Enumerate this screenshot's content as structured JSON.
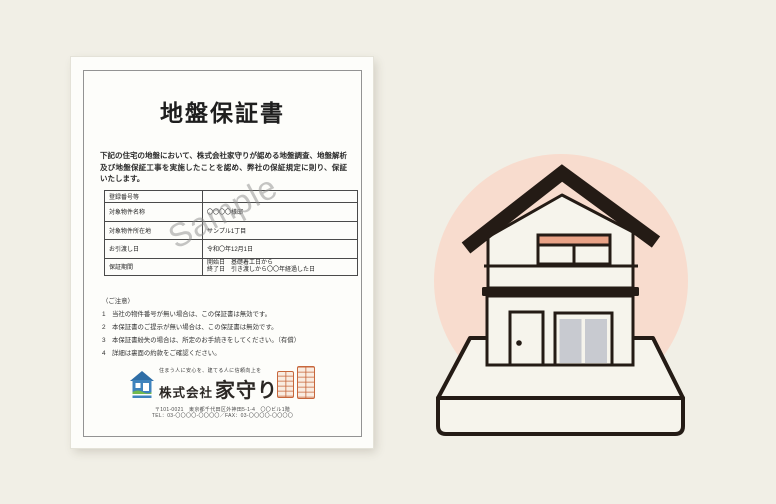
{
  "colors": {
    "page_background": "#f1efe6",
    "paper": "#fdfdfa",
    "ink": "#1e1e1e",
    "table_border": "#4a4a4a",
    "watermark_gray": "#8c8c8c",
    "line_art": "#241b15",
    "wall": "#f6f4ec",
    "backdrop_circle": "#f8dcce",
    "balcony_rail": "#e9a286",
    "glass": "#c8cad0",
    "seal_orange": "#c7673c",
    "logo_blue": "#3e83bd",
    "logo_blue_dark": "#2f6ea6",
    "logo_green": "#72b94e"
  },
  "certificate": {
    "title": "地盤保証書",
    "intro": "下記の住宅の地盤において、株式会社家守りが認める地盤調査、地盤解析及び地盤保証工事を実施したことを認め、弊社の保証規定に則り、保証いたします。",
    "watermark": "Sample",
    "table": {
      "rows": [
        {
          "label": "登録番号等",
          "value": ""
        },
        {
          "label": "対象物件名称",
          "value": "〇〇〇〇様邸"
        },
        {
          "label": "対象物件所在地",
          "value": "サンプル1丁目"
        },
        {
          "label": "お引渡し日",
          "value": "令和〇年12月1日"
        },
        {
          "label": "保証期間",
          "value": "開始日　基礎着工日から",
          "value2": "終了日　引き渡しから〇〇年経過した日"
        }
      ]
    },
    "notes": {
      "heading": "（ご注意）",
      "items": [
        "1　当社の物件番号が無い場合は、この保証書は無効です。",
        "2　本保証書のご提示が無い場合は、この保証書は無効です。",
        "3　本保証書紛失の場合は、所定のお手続きをしてください。（有償）",
        "4　詳細は裏面の約款をご確認ください。"
      ]
    },
    "company": {
      "tagline": "住まう人に安心を、建てる人に信頼向上を",
      "name_prefix": "株式会社",
      "name": "家守り",
      "address_line1": "〒101-0021　東京都千代田区外神田5-1-4　〇〇ビル1階",
      "address_line2": "TEL：03-〇〇〇〇-〇〇〇〇／FAX：03-〇〇〇〇-〇〇〇〇"
    }
  },
  "illustration": {
    "type": "two-story house line drawing on ground slab with pink circle backdrop",
    "elements": [
      "pink-circle-backdrop",
      "gable-roof",
      "balcony-rail",
      "floor-band",
      "front-door",
      "door-knob",
      "sliding-glass-door",
      "ground-slab"
    ]
  }
}
